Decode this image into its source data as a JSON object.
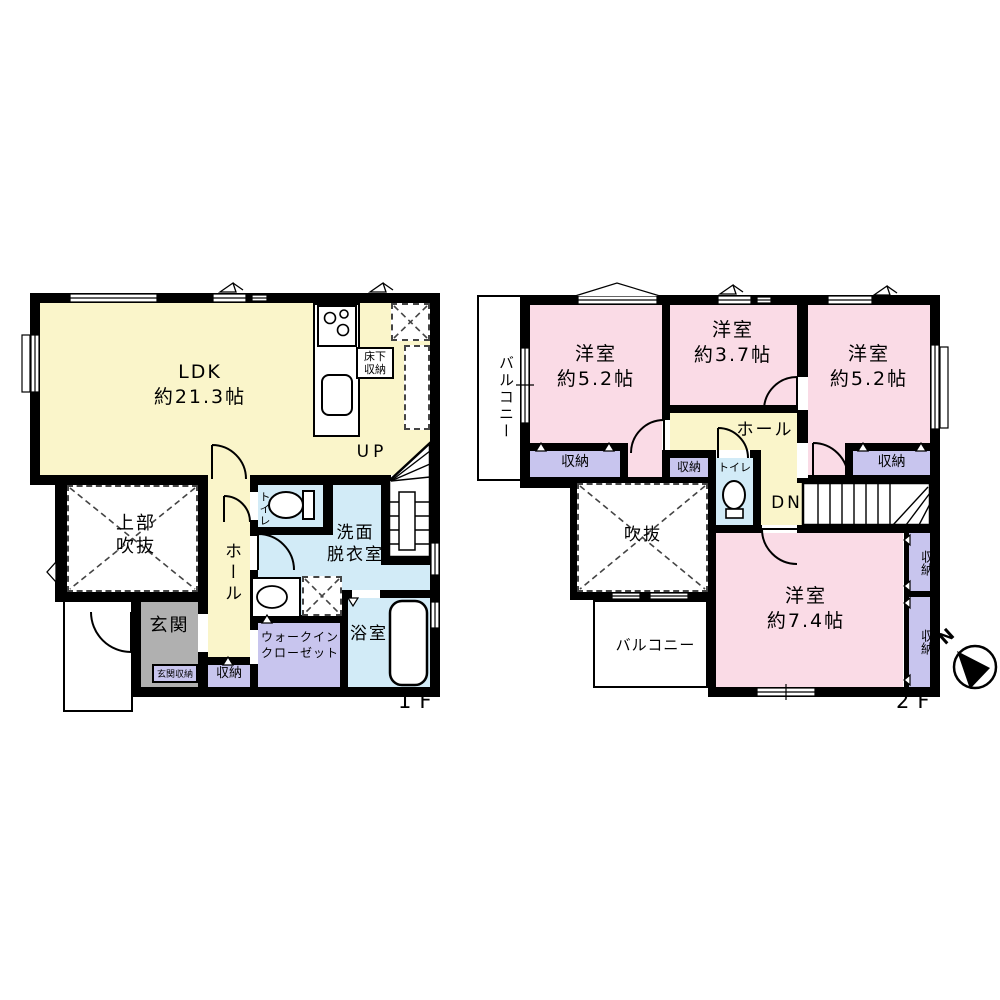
{
  "floor1": {
    "floor_label": "1F",
    "ldk_name": "LDK",
    "ldk_size": "約21.3帖",
    "underfloor_l1": "床下",
    "underfloor_l2": "収納",
    "stairs_label": "UP",
    "void_l1": "上部",
    "void_l2": "吹抜",
    "hall": "ホール",
    "toilet": "トイレ",
    "wash_l1": "洗面",
    "wash_l2": "脱衣室",
    "entrance": "玄関",
    "entrance_storage": "玄関収納",
    "storage": "収納",
    "wic_l1": "ウォークイン",
    "wic_l2": "クローゼット",
    "bath": "浴室"
  },
  "floor2": {
    "floor_label": "2F",
    "balcony_west": "バルコニー",
    "balcony_south": "バルコニー",
    "room_nw_name": "洋室",
    "room_nw_size": "約5.2帖",
    "room_n_name": "洋室",
    "room_n_size": "約3.7帖",
    "room_ne_name": "洋室",
    "room_ne_size": "約5.2帖",
    "room_s_name": "洋室",
    "room_s_size": "約7.4帖",
    "hall": "ホール",
    "toilet": "トイレ",
    "stairs_label": "DN",
    "void": "吹抜",
    "storage_nw": "収納",
    "storage_hall": "収納",
    "storage_ne": "収納",
    "storage_e1": "収納",
    "storage_e2": "収納"
  },
  "compass": {
    "north": "N"
  },
  "colors": {
    "ldk_yellow": "#faf5ca",
    "bedroom_pink": "#fadbe6",
    "wet_blue": "#d2ebf7",
    "storage_purple": "#c8c5ee",
    "entrance_gray": "#b0b0b0",
    "wall_black": "#000000"
  }
}
